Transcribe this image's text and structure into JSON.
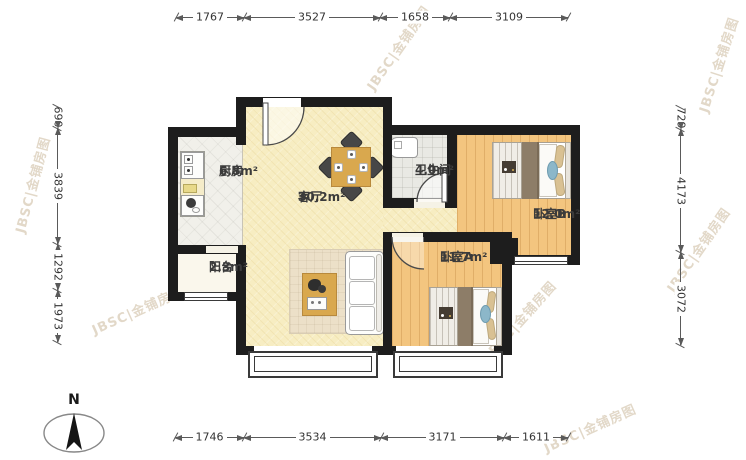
{
  "watermark": {
    "text": "JBSC|金铺房图"
  },
  "north": {
    "label": "N"
  },
  "rooms": {
    "kitchen": {
      "name": "厨房",
      "area": "6.8m²"
    },
    "living": {
      "name": "客厅",
      "area": "30.2m²"
    },
    "bath": {
      "name": "卫生间",
      "area": "4.0m²"
    },
    "balcony": {
      "name": "阳台",
      "area": "2.3m²"
    },
    "bedroomA": {
      "name": "卧室A",
      "area": "11.7m²"
    },
    "bedroomB": {
      "name": "卧室B",
      "area": "12.0m²"
    }
  },
  "dimensions": {
    "top": [
      "1767",
      "3527",
      "1658",
      "3109"
    ],
    "bottom": [
      "1746",
      "3534",
      "3171",
      "1611"
    ],
    "left": [
      "690",
      "3839",
      "1292",
      "1973"
    ],
    "right": [
      "729",
      "4173",
      "3072"
    ]
  }
}
